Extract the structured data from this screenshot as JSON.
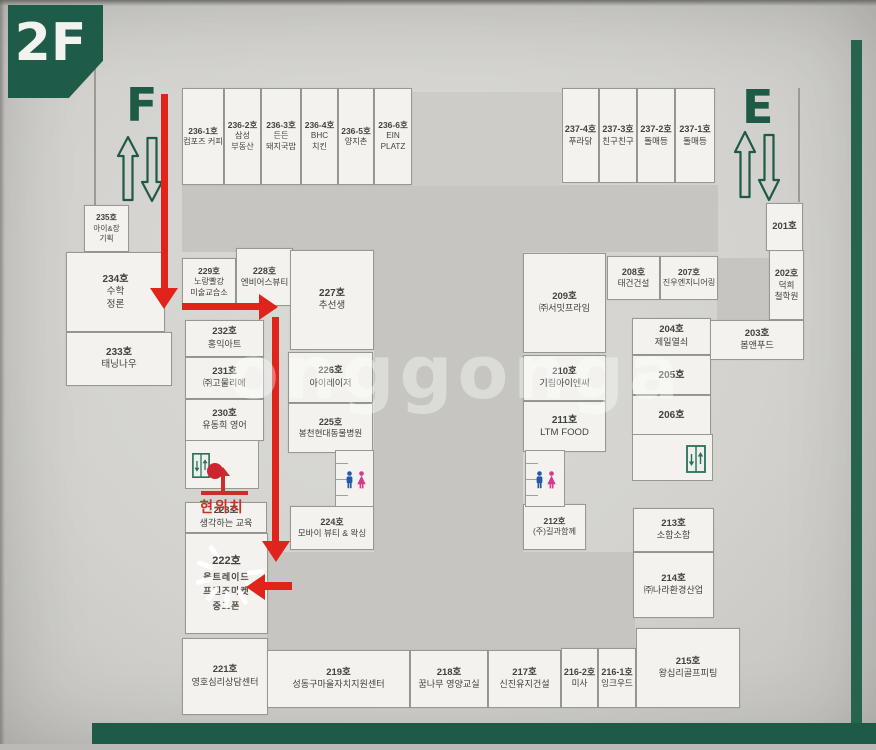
{
  "badge": {
    "label": "2F"
  },
  "stairs": {
    "west": "F",
    "east": "E"
  },
  "current_location_label": "현위치",
  "watermark": "onggonga",
  "colors": {
    "green": "#1d5b47",
    "path_red": "#e0241c",
    "marker_red": "#ce2430",
    "male_icon": "#2458a6",
    "female_icon": "#d8388d"
  },
  "room222": {
    "label": "222호",
    "lines": [
      "올트레이드",
      "프랜즈마켓",
      "중고폰"
    ]
  },
  "rooms": [
    {
      "id": "236-1",
      "label": "236-1호",
      "lines": [
        "컴포즈 커피"
      ]
    },
    {
      "id": "236-2",
      "label": "236-2호",
      "lines": [
        "삼성",
        "부동산"
      ]
    },
    {
      "id": "236-3",
      "label": "236-3호",
      "lines": [
        "든든",
        "돼지국밥"
      ]
    },
    {
      "id": "236-4",
      "label": "236-4호",
      "lines": [
        "BHC",
        "치킨"
      ]
    },
    {
      "id": "236-5",
      "label": "236-5호",
      "lines": [
        "양지촌"
      ]
    },
    {
      "id": "236-6",
      "label": "236-6호",
      "lines": [
        "EIN",
        "PLATZ"
      ]
    },
    {
      "id": "237-4",
      "label": "237-4호",
      "lines": [
        "푸라닭"
      ]
    },
    {
      "id": "237-3",
      "label": "237-3호",
      "lines": [
        "친구친구"
      ]
    },
    {
      "id": "237-2",
      "label": "237-2호",
      "lines": [
        "돌매등"
      ]
    },
    {
      "id": "237-1",
      "label": "237-1호",
      "lines": [
        "돌매등"
      ]
    },
    {
      "id": "235",
      "label": "235호",
      "lines": [
        "아이&장",
        "기획"
      ]
    },
    {
      "id": "234",
      "label": "234호",
      "lines": [
        "수학",
        "정론"
      ]
    },
    {
      "id": "233",
      "label": "233호",
      "lines": [
        "태닝나우"
      ]
    },
    {
      "id": "232",
      "label": "232호",
      "lines": [
        "홍익아트"
      ]
    },
    {
      "id": "231",
      "label": "231호",
      "lines": [
        "㈜고물리에"
      ]
    },
    {
      "id": "230",
      "label": "230호",
      "lines": [
        "유동희 영어"
      ]
    },
    {
      "id": "229",
      "label": "229호",
      "lines": [
        "노랑빨강",
        "미술교습소"
      ]
    },
    {
      "id": "228",
      "label": "228호",
      "lines": [
        "엔비어스뷰티"
      ]
    },
    {
      "id": "227",
      "label": "227호",
      "lines": [
        "추선생"
      ]
    },
    {
      "id": "226",
      "label": "226호",
      "lines": [
        "아이레이저"
      ]
    },
    {
      "id": "225",
      "label": "225호",
      "lines": [
        "봉천현대동물병원"
      ]
    },
    {
      "id": "224",
      "label": "224호",
      "lines": [
        "모바이 뷰티 & 왁싱"
      ]
    },
    {
      "id": "223",
      "label": "223호",
      "lines": [
        "생각하는 교육"
      ]
    },
    {
      "id": "221",
      "label": "221호",
      "lines": [
        "영호심리상담센터"
      ]
    },
    {
      "id": "219",
      "label": "219호",
      "lines": [
        "성동구마을자치지원센터"
      ]
    },
    {
      "id": "218",
      "label": "218호",
      "lines": [
        "꿈나무 영양교실"
      ]
    },
    {
      "id": "217",
      "label": "217호",
      "lines": [
        "신진유지건설"
      ]
    },
    {
      "id": "216-2",
      "label": "216-2호",
      "lines": [
        "미사"
      ]
    },
    {
      "id": "216-1",
      "label": "216-1호",
      "lines": [
        "잉크우드"
      ]
    },
    {
      "id": "215",
      "label": "215호",
      "lines": [
        "왕십리골프피팅"
      ]
    },
    {
      "id": "214",
      "label": "214호",
      "lines": [
        "㈜나라환경산업"
      ]
    },
    {
      "id": "213",
      "label": "213호",
      "lines": [
        "소함소함"
      ]
    },
    {
      "id": "212",
      "label": "212호",
      "lines": [
        "(주)길과함께"
      ]
    },
    {
      "id": "211",
      "label": "211호",
      "lines": [
        "LTM FOOD"
      ]
    },
    {
      "id": "210",
      "label": "210호",
      "lines": [
        "기림아이엔씨"
      ]
    },
    {
      "id": "209",
      "label": "209호",
      "lines": [
        "㈜서밋프라임"
      ]
    },
    {
      "id": "208",
      "label": "208호",
      "lines": [
        "태건건설"
      ]
    },
    {
      "id": "207",
      "label": "207호",
      "lines": [
        "진우엔지니어링"
      ]
    },
    {
      "id": "204",
      "label": "204호",
      "lines": [
        "제일열쇠"
      ]
    },
    {
      "id": "205",
      "label": "205호",
      "lines": []
    },
    {
      "id": "206",
      "label": "206호",
      "lines": []
    },
    {
      "id": "203",
      "label": "203호",
      "lines": [
        "봄앤푸드"
      ]
    },
    {
      "id": "202",
      "label": "202호",
      "lines": [
        "덕희",
        "철학원"
      ]
    },
    {
      "id": "201",
      "label": "201호",
      "lines": []
    }
  ]
}
